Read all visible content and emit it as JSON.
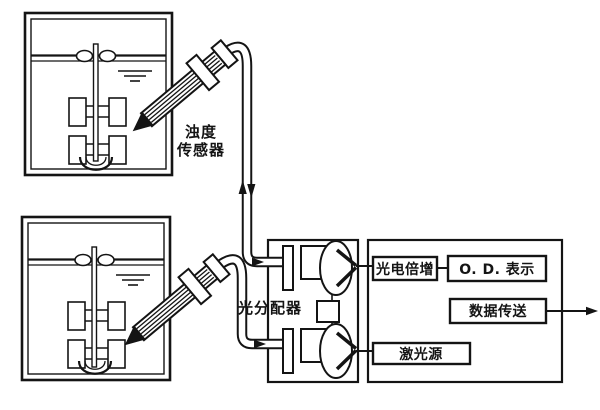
{
  "diagram": {
    "type": "optical-turbidity-measurement-system-schematic",
    "labels": {
      "turbidity_sensor_line1": "浊度",
      "turbidity_sensor_line2": "传感器",
      "light_distributor": "光分配器",
      "photomultiplier": "光电倍增",
      "od_display": "O. D. 表示",
      "data_transfer": "数据传送",
      "laser_source": "激光源"
    },
    "colors": {
      "ink": "#141414",
      "background": "#ffffff"
    },
    "icons": [
      "fermenter-tank-icon",
      "stirrer-shaft-icon",
      "impeller-icon",
      "bottom-paddle-icon",
      "water-level-icon",
      "turbidity-probe-icon",
      "probe-tip-arrow-icon",
      "optical-fiber-cable-icon",
      "up-arrow-icon",
      "down-arrow-icon",
      "flow-arrow-icon",
      "lens-icon",
      "light-cone-icon",
      "beam-splitter-icon",
      "output-arrow-icon"
    ]
  }
}
